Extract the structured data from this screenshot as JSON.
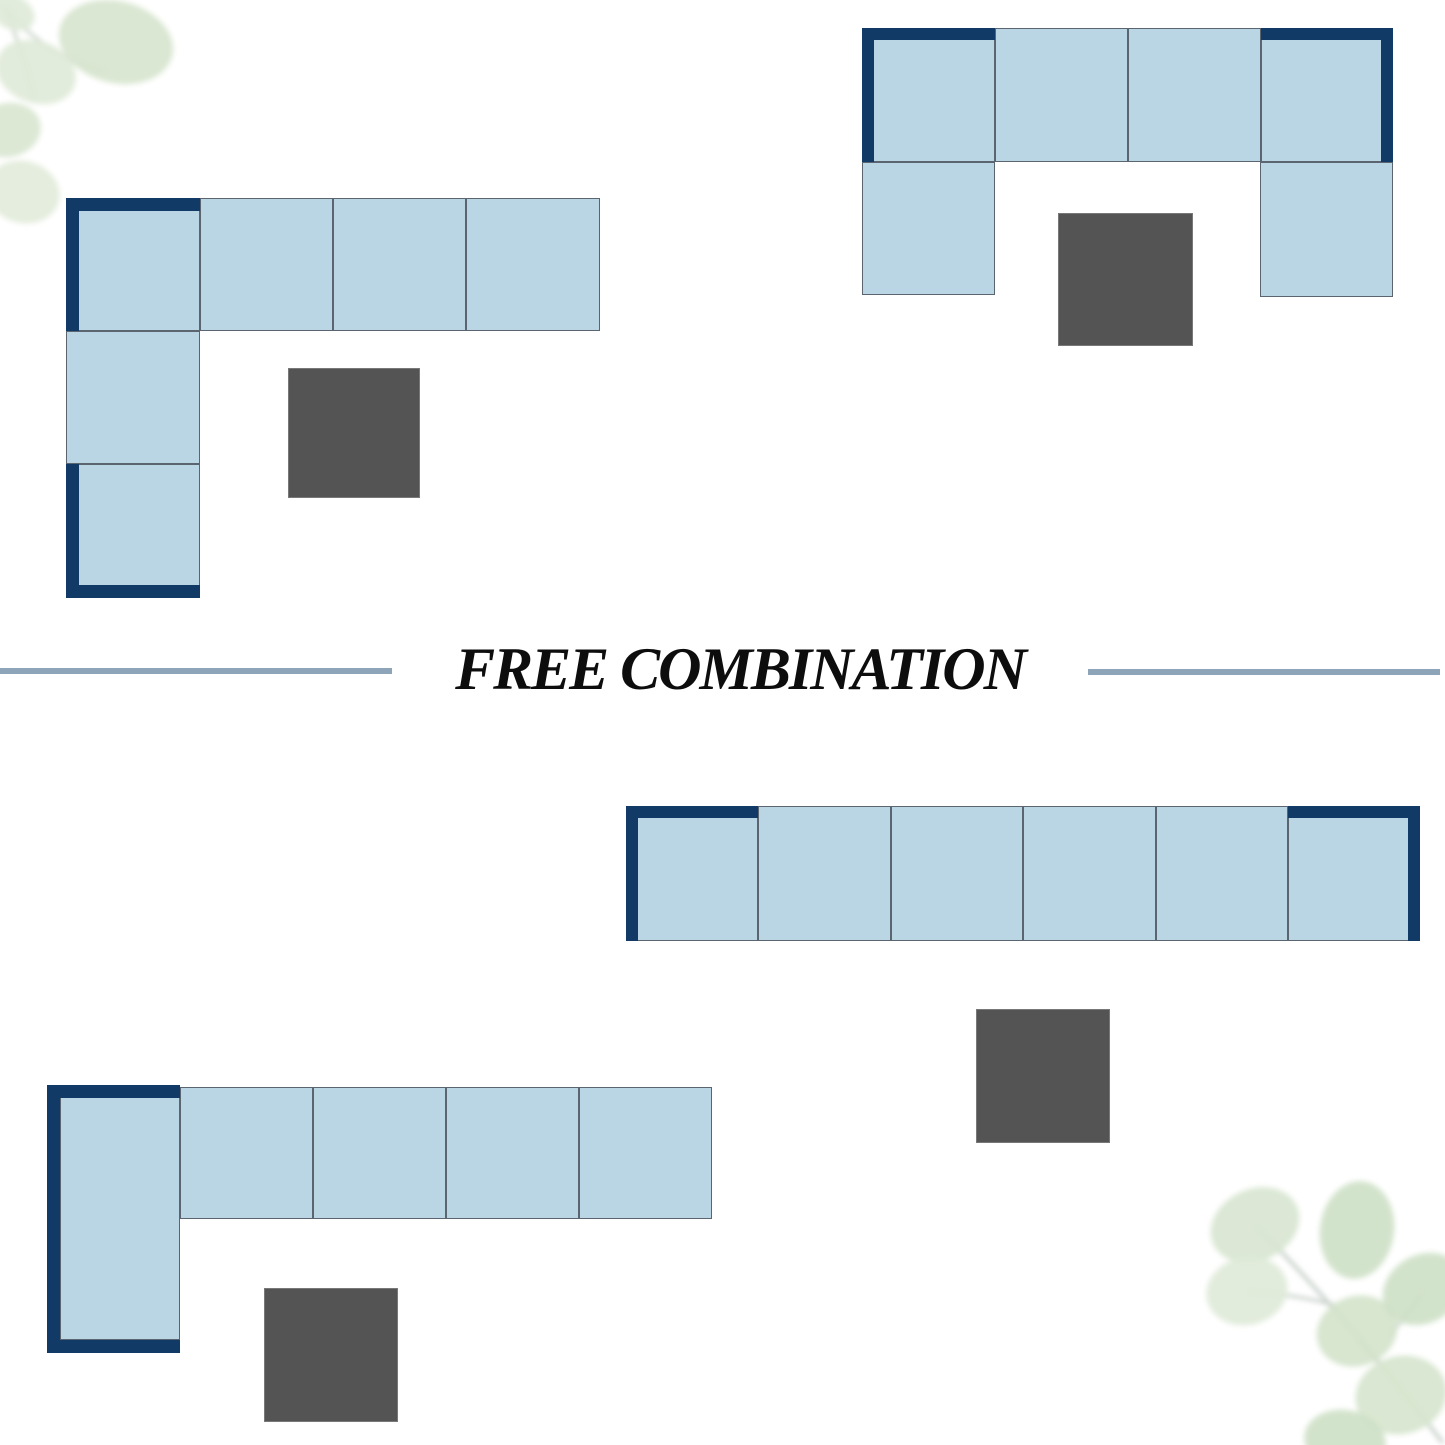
{
  "title": {
    "text": "FREE COMBINATION"
  },
  "canvas": {
    "width": 1445,
    "height": 1445
  },
  "colors": {
    "background": "#ffffff",
    "navy": "#113a67",
    "seat_fill": "#bad6e5",
    "seat_border": "#5a6570",
    "ottoman_fill": "#545454",
    "ottoman_border": "#787878",
    "divider_line": "#8da4b9",
    "title_text": "#0d0d0d",
    "leaf_light": "#dfead8",
    "leaf_dark": "#cde0c5",
    "leaf_stem": "#c9d2c9"
  },
  "layouts": [
    {
      "name": "corner-sectional-top-left",
      "seats": [
        {
          "x": 66,
          "y": 198,
          "w": 134,
          "h": 133
        },
        {
          "x": 200,
          "y": 198,
          "w": 133,
          "h": 133
        },
        {
          "x": 333,
          "y": 198,
          "w": 133,
          "h": 133
        },
        {
          "x": 466,
          "y": 198,
          "w": 134,
          "h": 133
        },
        {
          "x": 66,
          "y": 331,
          "w": 134,
          "h": 133
        },
        {
          "x": 66,
          "y": 464,
          "w": 134,
          "h": 134
        }
      ],
      "arms": [
        {
          "x": 66,
          "y": 198,
          "w": 134,
          "h": 13
        },
        {
          "x": 66,
          "y": 198,
          "w": 13,
          "h": 133
        },
        {
          "x": 66,
          "y": 464,
          "w": 13,
          "h": 134
        },
        {
          "x": 66,
          "y": 585,
          "w": 134,
          "h": 13
        }
      ],
      "ottoman": {
        "x": 288,
        "y": 368,
        "w": 132,
        "h": 130
      }
    },
    {
      "name": "u-shape-sectional-top-right",
      "seats": [
        {
          "x": 862,
          "y": 28,
          "w": 133,
          "h": 134
        },
        {
          "x": 995,
          "y": 28,
          "w": 133,
          "h": 134
        },
        {
          "x": 1128,
          "y": 28,
          "w": 133,
          "h": 134
        },
        {
          "x": 1261,
          "y": 28,
          "w": 132,
          "h": 134
        },
        {
          "x": 862,
          "y": 162,
          "w": 133,
          "h": 133
        },
        {
          "x": 1260,
          "y": 162,
          "w": 133,
          "h": 135
        }
      ],
      "arms": [
        {
          "x": 862,
          "y": 28,
          "w": 133,
          "h": 12
        },
        {
          "x": 862,
          "y": 28,
          "w": 12,
          "h": 134
        },
        {
          "x": 1261,
          "y": 28,
          "w": 132,
          "h": 12
        },
        {
          "x": 1381,
          "y": 28,
          "w": 12,
          "h": 134
        }
      ],
      "ottoman": {
        "x": 1058,
        "y": 213,
        "w": 135,
        "h": 133
      }
    },
    {
      "name": "straight-sofa-bottom-right",
      "seats": [
        {
          "x": 626,
          "y": 806,
          "w": 132,
          "h": 135
        },
        {
          "x": 758,
          "y": 806,
          "w": 133,
          "h": 135
        },
        {
          "x": 891,
          "y": 806,
          "w": 132,
          "h": 135
        },
        {
          "x": 1023,
          "y": 806,
          "w": 133,
          "h": 135
        },
        {
          "x": 1156,
          "y": 806,
          "w": 132,
          "h": 135
        },
        {
          "x": 1288,
          "y": 806,
          "w": 132,
          "h": 135
        }
      ],
      "arms": [
        {
          "x": 626,
          "y": 806,
          "w": 132,
          "h": 12
        },
        {
          "x": 626,
          "y": 806,
          "w": 12,
          "h": 135
        },
        {
          "x": 1288,
          "y": 806,
          "w": 132,
          "h": 12
        },
        {
          "x": 1408,
          "y": 806,
          "w": 12,
          "h": 135
        }
      ],
      "ottoman": {
        "x": 976,
        "y": 1009,
        "w": 134,
        "h": 134
      }
    },
    {
      "name": "chaise-sectional-bottom-left",
      "seats": [
        {
          "x": 60,
          "y": 1087,
          "w": 120,
          "h": 253
        },
        {
          "x": 180,
          "y": 1087,
          "w": 133,
          "h": 132
        },
        {
          "x": 313,
          "y": 1087,
          "w": 133,
          "h": 132
        },
        {
          "x": 446,
          "y": 1087,
          "w": 133,
          "h": 132
        },
        {
          "x": 579,
          "y": 1087,
          "w": 133,
          "h": 132
        }
      ],
      "arms": [
        {
          "x": 47,
          "y": 1085,
          "w": 133,
          "h": 13
        },
        {
          "x": 47,
          "y": 1085,
          "w": 13,
          "h": 268
        },
        {
          "x": 47,
          "y": 1340,
          "w": 133,
          "h": 13
        }
      ],
      "ottoman": {
        "x": 264,
        "y": 1288,
        "w": 134,
        "h": 134
      }
    }
  ],
  "decorations": [
    {
      "name": "eucalyptus-watercolor-top-left"
    },
    {
      "name": "eucalyptus-watercolor-bottom-right"
    }
  ]
}
